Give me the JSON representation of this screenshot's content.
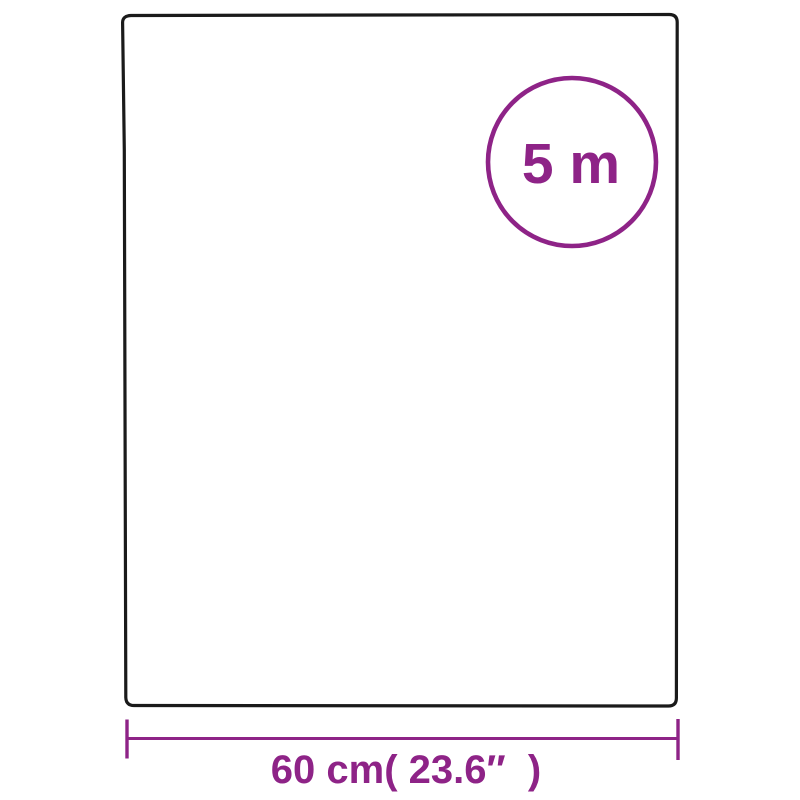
{
  "diagram": {
    "badge_label": "5 m",
    "width_label": "60 cm( 23.6″  )"
  },
  "colors": {
    "accent": "#8e2387",
    "outline": "#1a1a1a",
    "background": "#ffffff"
  }
}
